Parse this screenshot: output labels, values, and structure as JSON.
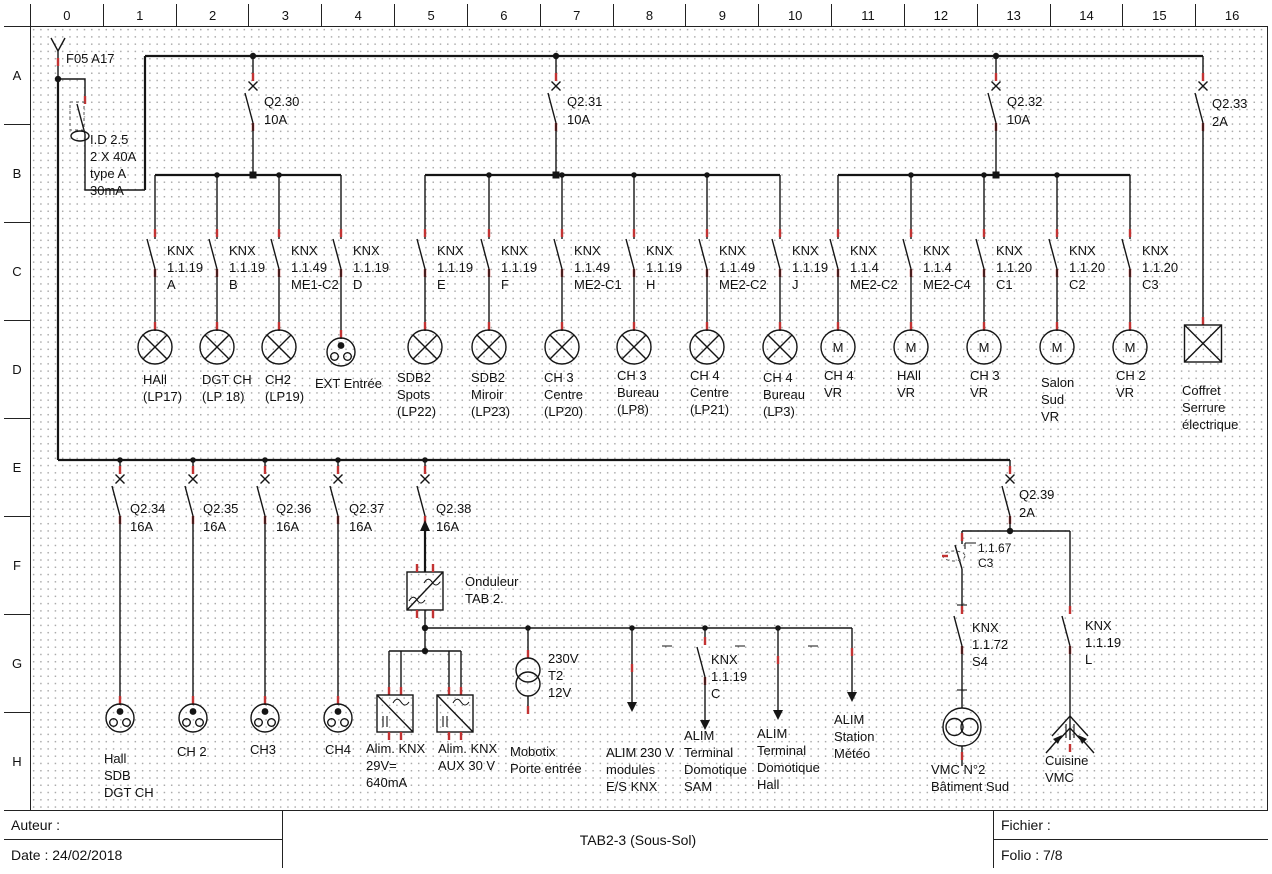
{
  "rulers": {
    "columns": [
      "0",
      "1",
      "2",
      "3",
      "4",
      "5",
      "6",
      "7",
      "8",
      "9",
      "10",
      "11",
      "12",
      "13",
      "14",
      "15",
      "16"
    ],
    "rows": [
      "A",
      "B",
      "C",
      "D",
      "E",
      "F",
      "G",
      "H"
    ]
  },
  "title_block": {
    "author_label": "Auteur :",
    "date_label": "Date : 24/02/2018",
    "drawing_title": "TAB2-3 (Sous-Sol)",
    "file_label": "Fichier :",
    "folio_label": "Folio : 7/8"
  },
  "incoming": {
    "feeder": "F05 A17",
    "rcd": "I.D 2.5\n2 X 40A\ntype A\n30mA"
  },
  "breakers": [
    {
      "name": "Q2.30",
      "rating": "10A"
    },
    {
      "name": "Q2.31",
      "rating": "10A"
    },
    {
      "name": "Q2.32",
      "rating": "10A"
    },
    {
      "name": "Q2.33",
      "rating": "2A"
    },
    {
      "name": "Q2.34",
      "rating": "16A"
    },
    {
      "name": "Q2.35",
      "rating": "16A"
    },
    {
      "name": "Q2.36",
      "rating": "16A"
    },
    {
      "name": "Q2.37",
      "rating": "16A"
    },
    {
      "name": "Q2.38",
      "rating": "16A"
    },
    {
      "name": "Q2.39",
      "rating": "2A"
    }
  ],
  "knx_contacts": [
    "KNX\n1.1.19\nA",
    "KNX\n1.1.19\nB",
    "KNX\n1.1.49\nME1-C2",
    "KNX\n1.1.19\nD",
    "KNX\n1.1.19\nE",
    "KNX\n1.1.19\nF",
    "KNX\n1.1.49\nME2-C1",
    "KNX\n1.1.19\nH",
    "KNX\n1.1.49\nME2-C2",
    "KNX\n1.1.19\nJ",
    "KNX\n1.1.4\nME2-C2",
    "KNX\n1.1.4\nME2-C4",
    "KNX\n1.1.20\nC1",
    "KNX\n1.1.20\nC2",
    "KNX\n1.1.20\nC3"
  ],
  "knx_lower": [
    "KNX\n1.1.19\nC",
    "KNX\n1.1.72\nS4",
    "KNX\n1.1.19\nL"
  ],
  "relay_contact": "1.1.67\nC3",
  "loads_row_d": [
    "HAll\n(LP17)",
    "DGT CH\n(LP 18)",
    "CH2\n(LP19)",
    "EXT Entrée",
    "SDB2\nSpots\n(LP22)",
    "SDB2\nMiroir\n(LP23)",
    "CH 3\nCentre\n(LP20)",
    "CH 3\nBureau\n(LP8)",
    "CH 4\nCentre\n(LP21)",
    "CH 4\nBureau\n(LP3)",
    "CH 4\nVR",
    "HAll\nVR",
    "CH 3\nVR",
    "Salon\nSud\nVR",
    "CH 2\nVR",
    "Coffret\nSerrure\nélectrique"
  ],
  "inverter_label": "Onduleur\nTAB 2.",
  "transformer_label": "230V\nT2\n12V",
  "loads_row_h": [
    "Hall\nSDB\nDGT CH",
    "CH 2",
    "CH3",
    "CH4",
    "Alim. KNX\n29V=\n640mA",
    "Alim. KNX\nAUX 30 V",
    "Mobotix\nPorte entrée",
    "ALIM 230 V\nmodules\nE/S KNX",
    "ALIM\nTerminal\nDomotique\nSAM",
    "ALIM\nTerminal\nDomotique\nHall",
    "ALIM\nStation\nMétéo",
    "VMC N°2\nBâtiment Sud",
    "Cuisine\nVMC"
  ],
  "symbols": {
    "motor_letter": "M"
  },
  "colors": {
    "wire": "#151515",
    "terminal_mark": "#c23333"
  }
}
